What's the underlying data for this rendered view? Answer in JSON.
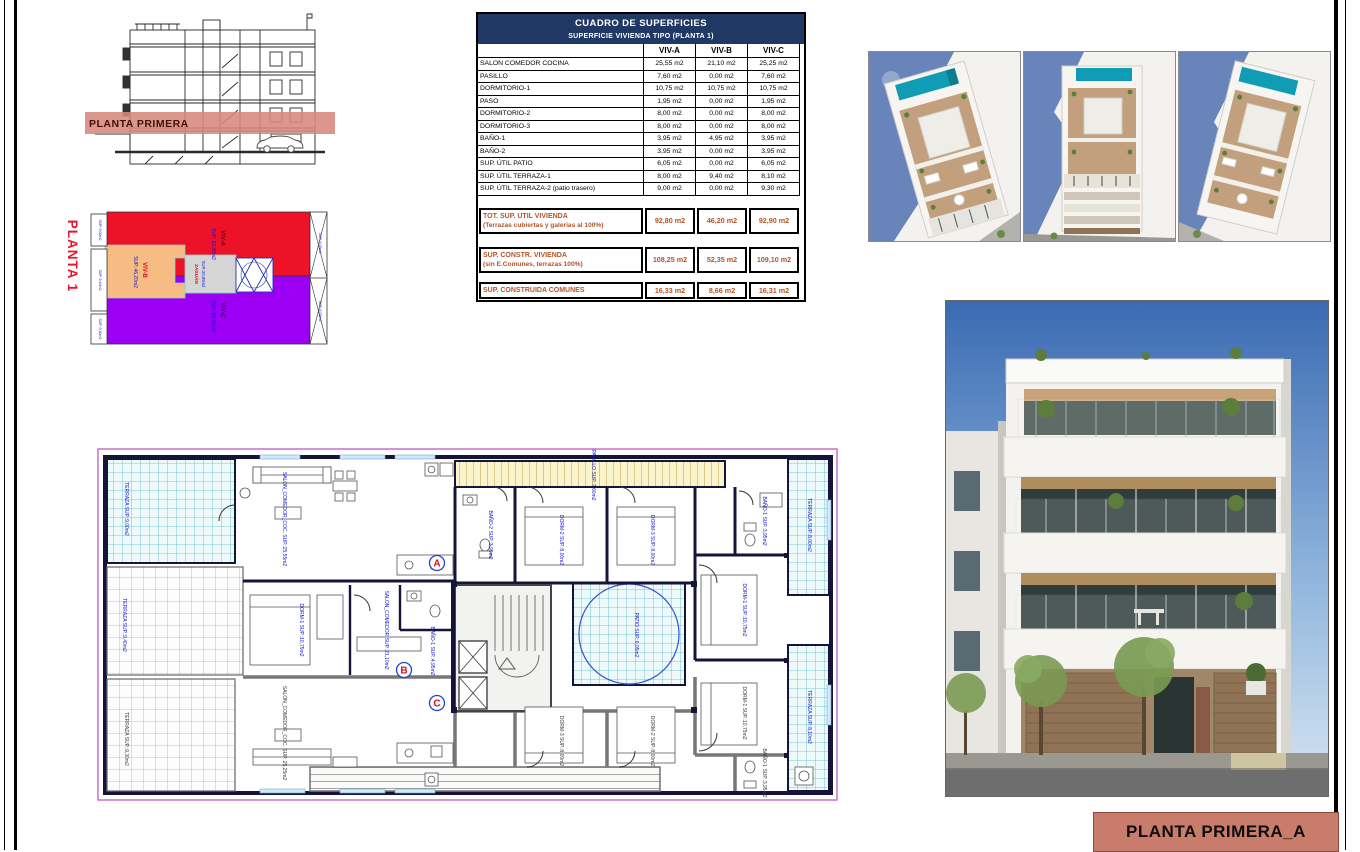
{
  "colors": {
    "viv_a_red": "#ee1228",
    "viv_b_orange": "#f6bc84",
    "viv_c_purple": "#9b00f5",
    "zaguan_gray": "#d5d5d5",
    "band_salmon": "#d6897b",
    "title_bg": "#c97c6b",
    "table_header_bg": "#203864",
    "totals_text": "#b35426",
    "label_blue": "#1414d8",
    "pool_teal": "#0f9cb4"
  },
  "section": {
    "band_label": "PLANTA PRIMERA"
  },
  "schematic": {
    "title": "PLANTA 1",
    "viv_a": {
      "name": "VIV-A",
      "sup": "SUP.:92,80m2"
    },
    "viv_b": {
      "name": "VIV-B",
      "sup": "SUP.:46,20m2"
    },
    "viv_c": {
      "name": "VIV-C",
      "sup": "SUP.:92,90m2"
    },
    "zaguan": {
      "name": "ZAGUÁN",
      "sup": "SUP.:20,85m2"
    },
    "terraza_a": "SUP.:9,00m2",
    "terraza_b": "SUP.:9,40m2",
    "terraza_c": "SUP.:9,30m2",
    "patio_a": "SUP.:6,05m2",
    "patio_c": "SUP.:6,05m2"
  },
  "table": {
    "title": "CUADRO DE SUPERFICIES",
    "subtitle": "SUPERFICIE VIVIENDA TIPO  (PLANTA 1)",
    "col_a": "VIV-A",
    "col_b": "VIV-B",
    "col_c": "VIV-C",
    "rows": [
      {
        "label": "SALON COMEDOR COCINA",
        "a": "25,55 m2",
        "b": "21,10 m2",
        "c": "25,25 m2"
      },
      {
        "label": "PASILLO",
        "a": "7,60 m2",
        "b": "0,00 m2",
        "c": "7,60 m2"
      },
      {
        "label": "DORMITORIO-1",
        "a": "10,75 m2",
        "b": "10,75 m2",
        "c": "10,75 m2"
      },
      {
        "label": "PASO",
        "a": "1,95 m2",
        "b": "0,00 m2",
        "c": "1,95 m2"
      },
      {
        "label": "DORMITORIO-2",
        "a": "8,00 m2",
        "b": "0,00 m2",
        "c": "8,00 m2"
      },
      {
        "label": "DORMITORIO-3",
        "a": "8,00 m2",
        "b": "0,00 m2",
        "c": "8,00 m2"
      },
      {
        "label": "BAÑO-1",
        "a": "3,95 m2",
        "b": "4,95 m2",
        "c": "3,95 m2"
      },
      {
        "label": "BAÑO-2",
        "a": "3,95 m2",
        "b": "0,00 m2",
        "c": "3,95 m2"
      },
      {
        "label": "SUP. ÚTIL PATIO",
        "a": "6,05 m2",
        "b": "0,00 m2",
        "c": "6,05 m2"
      },
      {
        "label": "SUP. ÚTIL TERRAZA-1",
        "a": "8,00 m2",
        "b": "9,40 m2",
        "c": "8,10 m2"
      },
      {
        "label": "SUP. ÚTIL TERRAZA-2 (patio trasero)",
        "a": "9,00 m2",
        "b": "0,00 m2",
        "c": "9,30 m2"
      }
    ],
    "totals": [
      {
        "label": "TOT. SUP. UTIL VIVIENDA",
        "sublabel": "(Terrazas cubiertas y galerias al 100%)",
        "a": "92,80 m2",
        "b": "46,20 m2",
        "c": "92,90 m2"
      },
      {
        "label": "SUP. CONSTR. VIVIENDA",
        "sublabel": "(sin E.Comunes, terrazas 100%)",
        "a": "108,25 m2",
        "b": "52,35 m2",
        "c": "109,10 m2"
      },
      {
        "label": "SUP. CONSTRUIDA COMUNES",
        "sublabel": "",
        "a": "16,33 m2",
        "b": "8,66 m2",
        "c": "16,31 m2"
      }
    ]
  },
  "plan": {
    "labels": {
      "terraza_tl": "TERRAZA SUP.:9,00m2",
      "terraza_ml": "TERRAZA SUP.:9,40m2",
      "terraza_bl": "TERRAZA SUP.:9,30m2",
      "terraza_tr": "TERRAZA SUP.:8,00m2",
      "terraza_br": "TERRAZA SUP.:8,10m2",
      "salon_a": "SALON_COMEDOR_COC. SUP.:25,55m2",
      "pasillo": "PASILLO SUP.:7,60m2",
      "banyo2_a": "BAÑO-2 SUP.:3,95m2",
      "dorm2_a": "DORM-2 SUP.:8,00m2",
      "dorm3_a": "DORM-3 SUP.:8,00m2",
      "banyo1_a": "BAÑO-1 SUP.:3,95m2",
      "dorm1_a": "DORM-1 SUP.:10,75m2",
      "patio": "PATIO SUP.:6,05m2",
      "salon_b": "SALON_COMEDOR SUP.:21,10m2",
      "dorm1_b": "DORM-1 SUP.:10,75m2",
      "banyo1_b": "BAÑO-1 SUP.:4,95m2",
      "salon_c": "SALON_COMEDOR_COC. SUP.:25,25m2",
      "dorm3_c": "DORM-3 SUP.:8,00m2",
      "dorm2_c": "DORM-2 SUP.:8,00m2",
      "dorm1_c": "DORM-1 SUP.:10,75m2",
      "banyo1_c": "BAÑO-1 SUP.:3,95m2"
    },
    "markers": {
      "a": "A",
      "b": "B",
      "c": "C"
    }
  },
  "title_block": {
    "label": "PLANTA PRIMERA_A"
  }
}
